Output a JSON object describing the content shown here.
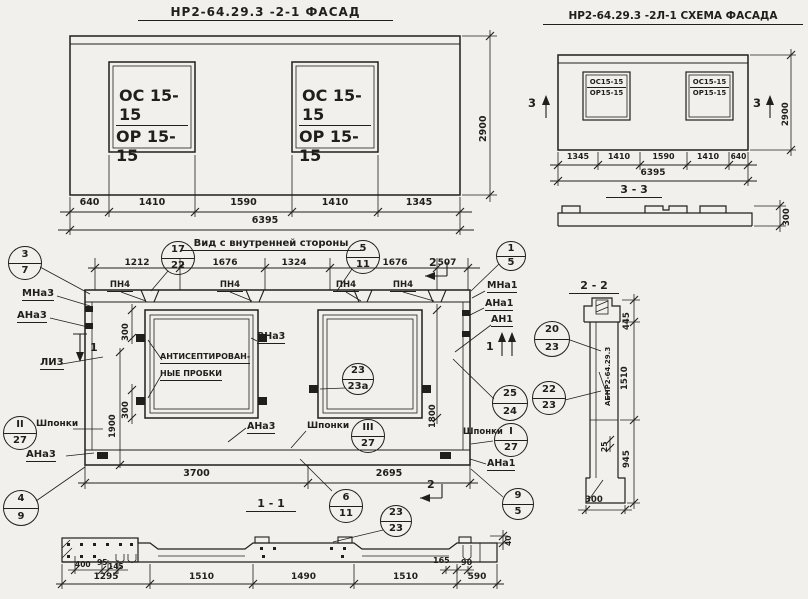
{
  "colors": {
    "ink": "#211f1c",
    "paper": "#f1f0ec"
  },
  "facade": {
    "title": "НР2-64.29.3 -2-1  ФАСАД",
    "window_top": "ОС 15-15",
    "window_bottom": "ОР 15-15",
    "dims": [
      "640",
      "1410",
      "1590",
      "1410",
      "1345"
    ],
    "total": "6395",
    "height": "2900"
  },
  "schema": {
    "title": "НР2-64.29.3 -2Л-1 СХЕМА ФАСАДА",
    "window_top": "ОС15-15",
    "window_bottom": "ОР15-15",
    "dims": [
      "1345",
      "1410",
      "1590",
      "1410",
      "640"
    ],
    "total": "6395",
    "height": "2900",
    "mark": "3",
    "section33": {
      "title": "3 - 3",
      "thickness": "300"
    }
  },
  "interior": {
    "title": "Вид с внутренней стороны",
    "top_dims": [
      "1212",
      "1676",
      "1324",
      "1676",
      "507"
    ],
    "pn4": "ПН4",
    "mark2": "2",
    "mark1": "1",
    "labels": {
      "mna3": "МНа3",
      "ana3_top": "АНа3",
      "li3": "ЛИ3",
      "shponki_left": "Шпонки",
      "ana3_bl": "АНа3",
      "plug1": "АНТИСЕПТИРОВАН-",
      "plug2": "НЫЕ ПРОБКИ",
      "vna3": "ВНа3",
      "ana3_c": "АНа3",
      "shponki_mid": "Шпонки",
      "mna1": "МНа1",
      "ana1_top": "АНа1",
      "an1": "АН1",
      "shponki_right": "Шпонки",
      "ana1_bot": "АНа1"
    },
    "vdims": {
      "v300a": "300",
      "v1900": "1900",
      "v300b": "300",
      "v1800": "1800"
    },
    "bottom_dims": [
      "3700",
      "2695"
    ],
    "section_title": "1 - 1"
  },
  "callouts": {
    "c3_7": {
      "top": "3",
      "bottom": "7"
    },
    "c17_22": {
      "top": "17",
      "bottom": "22"
    },
    "c5_11": {
      "top": "5",
      "bottom": "11"
    },
    "c1_5": {
      "top": "1",
      "bottom": "5"
    },
    "cII_27": {
      "top": "II",
      "bottom": "27"
    },
    "cIII_27": {
      "top": "III",
      "bottom": "27"
    },
    "c23_23a": {
      "top": "23",
      "bottom": "23а"
    },
    "c20_23": {
      "top": "20",
      "bottom": "23"
    },
    "c25_24": {
      "top": "25",
      "bottom": "24"
    },
    "c22_23": {
      "top": "22",
      "bottom": "23"
    },
    "cI_27": {
      "top": "I",
      "bottom": "27"
    },
    "c4_9": {
      "top": "4",
      "bottom": "9"
    },
    "c6_11": {
      "top": "6",
      "bottom": "11"
    },
    "c23_23": {
      "top": "23",
      "bottom": "23"
    },
    "c9_5": {
      "top": "9",
      "bottom": "5"
    }
  },
  "section22": {
    "title": "2 - 2",
    "d445": "445",
    "d1510": "1510",
    "d25": "25",
    "d945": "945",
    "d300": "300",
    "axis_label": "АБНР2-64.29.3"
  },
  "section11": {
    "small_dims": [
      "400",
      "95",
      "145"
    ],
    "dims": [
      "1295",
      "1510",
      "1490",
      "1510",
      "590"
    ],
    "d165": "165",
    "d90": "90",
    "d40": "40"
  }
}
